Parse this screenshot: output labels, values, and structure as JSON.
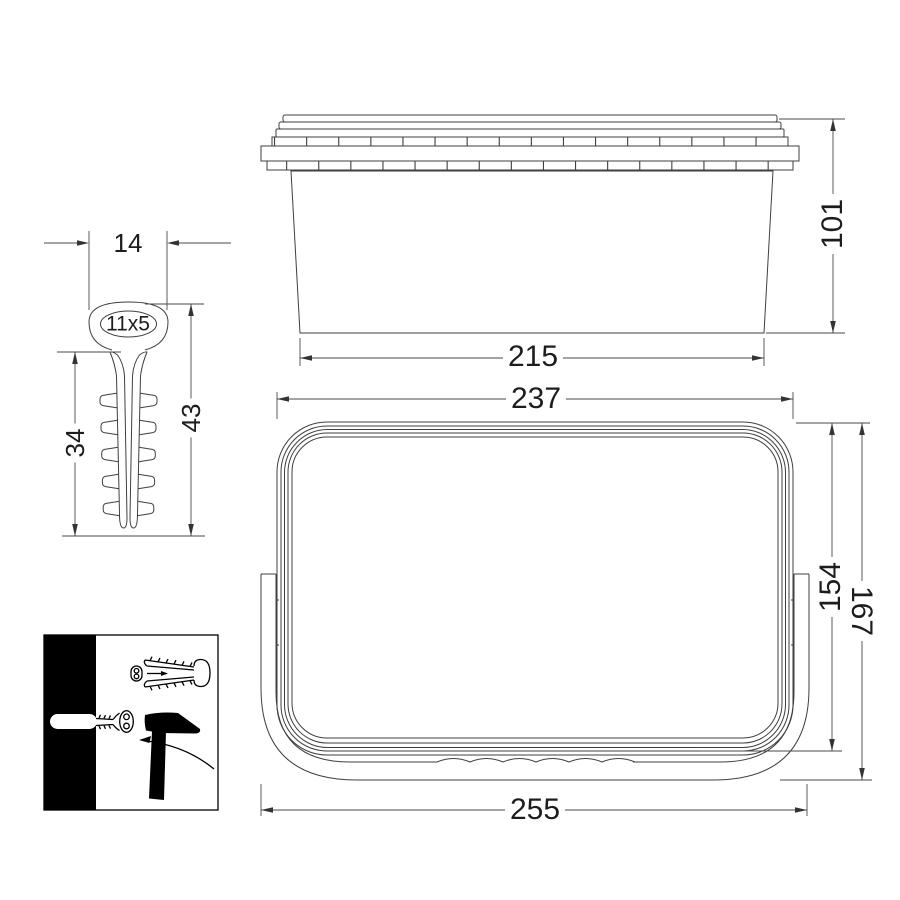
{
  "drawing": {
    "type": "technical-dimension-drawing",
    "subject": "rectangular bucket with lid, handle and nail-in wall plug",
    "colors": {
      "background": "#ffffff",
      "line": "#3f3f3f",
      "label": "#1d1d1d",
      "pictogram": "#000000"
    }
  },
  "labels": {
    "plug_width": "14",
    "plug_hole": "11x5",
    "plug_shaft_length": "34",
    "plug_total_length": "43",
    "side_height": "101",
    "side_bottom_width": "215",
    "top_lid_width": "237",
    "top_inner_depth": "154",
    "top_outer_depth": "167",
    "top_overall_width": "255"
  }
}
